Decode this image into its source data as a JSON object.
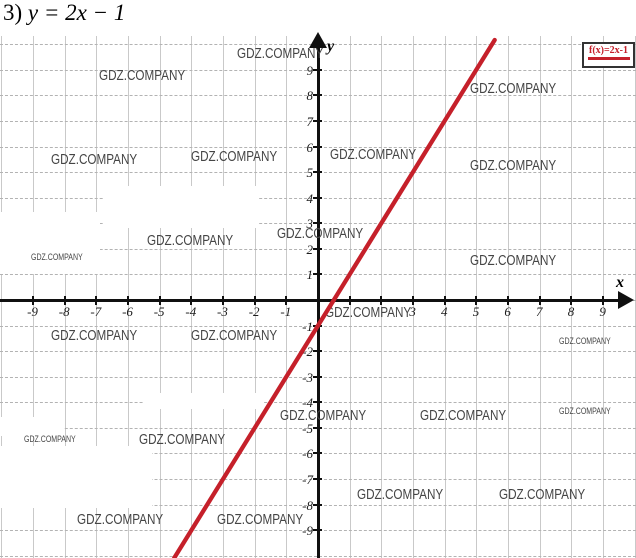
{
  "page": {
    "title_prefix": "3)",
    "title_equation": "y = 2x − 1"
  },
  "watermark": {
    "text": "GDZ.COMPANY",
    "color": "#454545"
  },
  "legend": {
    "label": "f(x)=2x-1",
    "text_color": "#c5202a",
    "border_color": "#333333",
    "underline_color": "#c5202a",
    "position": "top-right"
  },
  "chart_data": {
    "type": "line",
    "title": "3) y = 2x − 1",
    "xlabel": "x",
    "ylabel": "y",
    "xlim": [
      -10,
      10
    ],
    "ylim": [
      -10,
      10
    ],
    "grid": true,
    "legend_position": "top-right",
    "x_tick_labels": [
      -9,
      -8,
      -7,
      -6,
      -5,
      -4,
      -3,
      -2,
      -1,
      3,
      4,
      5,
      6,
      7,
      8,
      9
    ],
    "y_tick_labels": [
      9,
      8,
      7,
      6,
      5,
      4,
      3,
      2,
      1,
      -1,
      -2,
      -3,
      -4,
      -5,
      -6,
      -7,
      -8,
      -9
    ],
    "hidden_x_tick_labels": [
      1,
      2
    ],
    "series": [
      {
        "name": "f(x)=2x-1",
        "equation": "y = 2x − 1",
        "slope": 2,
        "intercept": -1,
        "color": "#c5202a",
        "points": [
          [
            -4.5,
            -10
          ],
          [
            -2,
            -5
          ],
          [
            -1,
            -3
          ],
          [
            0,
            -1
          ],
          [
            0.5,
            0
          ],
          [
            1,
            1
          ],
          [
            2,
            3
          ],
          [
            3,
            5
          ],
          [
            4,
            7
          ],
          [
            5.5,
            10
          ]
        ]
      }
    ]
  }
}
